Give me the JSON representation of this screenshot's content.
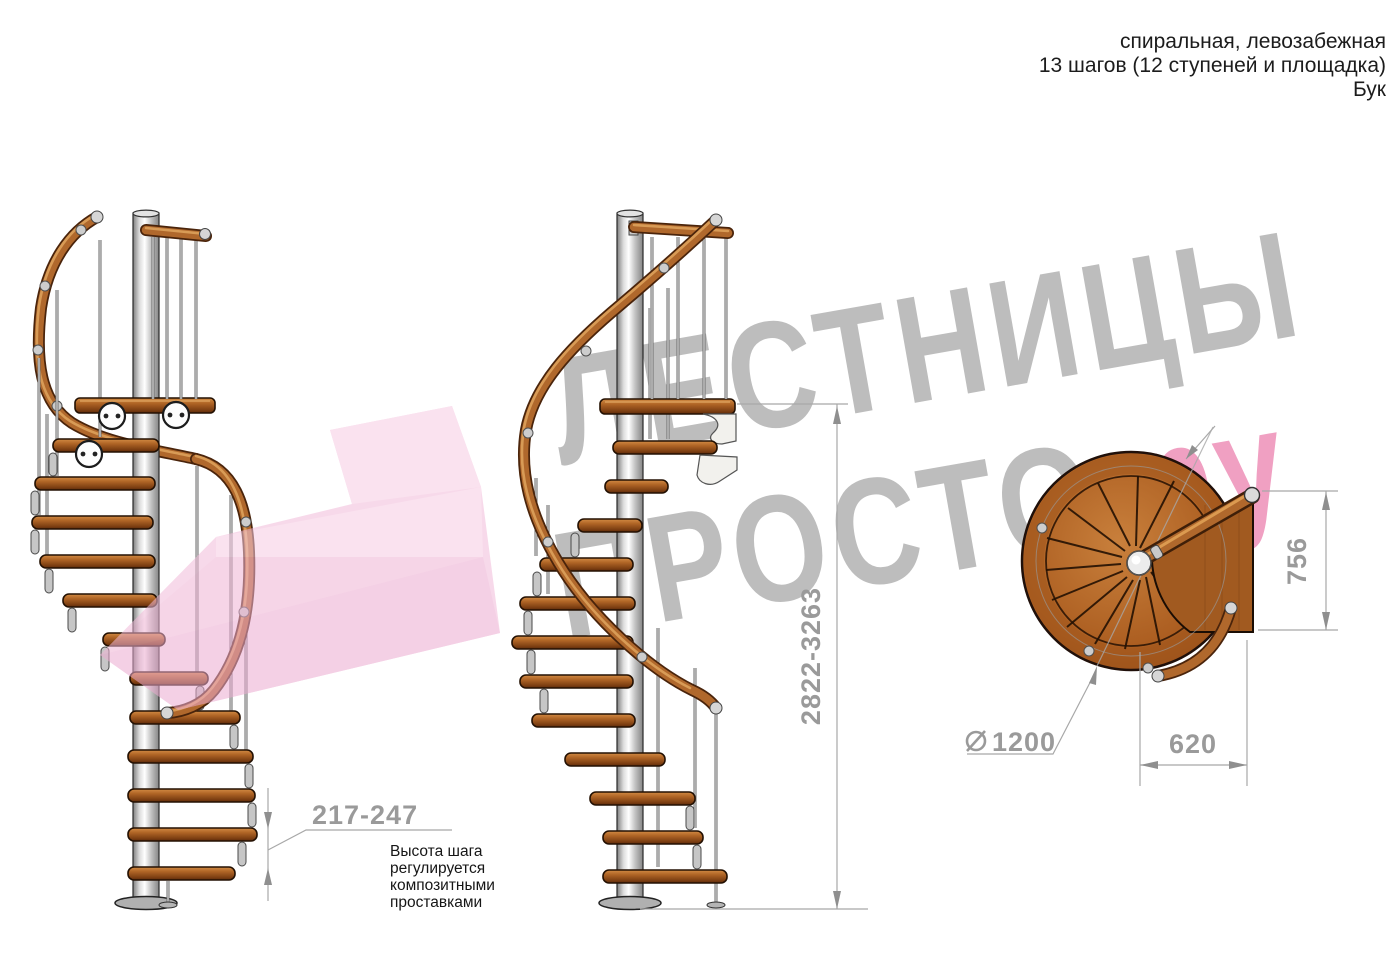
{
  "header": {
    "line1": "спиральная, левозабежная",
    "line2": "13 шагов (12 ступеней и площадка)",
    "line3": "Бук"
  },
  "watermark": {
    "line1": "ЛЕСТНИЦЫ",
    "line2_gray": "ПРОСТО",
    "line2_pink": ".ру",
    "gray_color": "#bdbdbd",
    "pink_color": "#f0a0c2",
    "arrow_pink_color": "#f2bbd9"
  },
  "dimensions": {
    "total_height": "2822-3263",
    "step_height": "217-247",
    "diameter_symbol": "⌀",
    "diameter": "1200",
    "landing_width": "620",
    "landing_depth": "756"
  },
  "annotations": {
    "step_note_line1": "Высота шага",
    "step_note_line2": "регулируется",
    "step_note_line3": "композитными",
    "step_note_line4": "проставками"
  },
  "colors": {
    "wood_mid": "#b0682c",
    "wood_dark": "#6f3610",
    "metal_light": "#e9e9e9",
    "dim_gray": "#9a9a9a"
  }
}
